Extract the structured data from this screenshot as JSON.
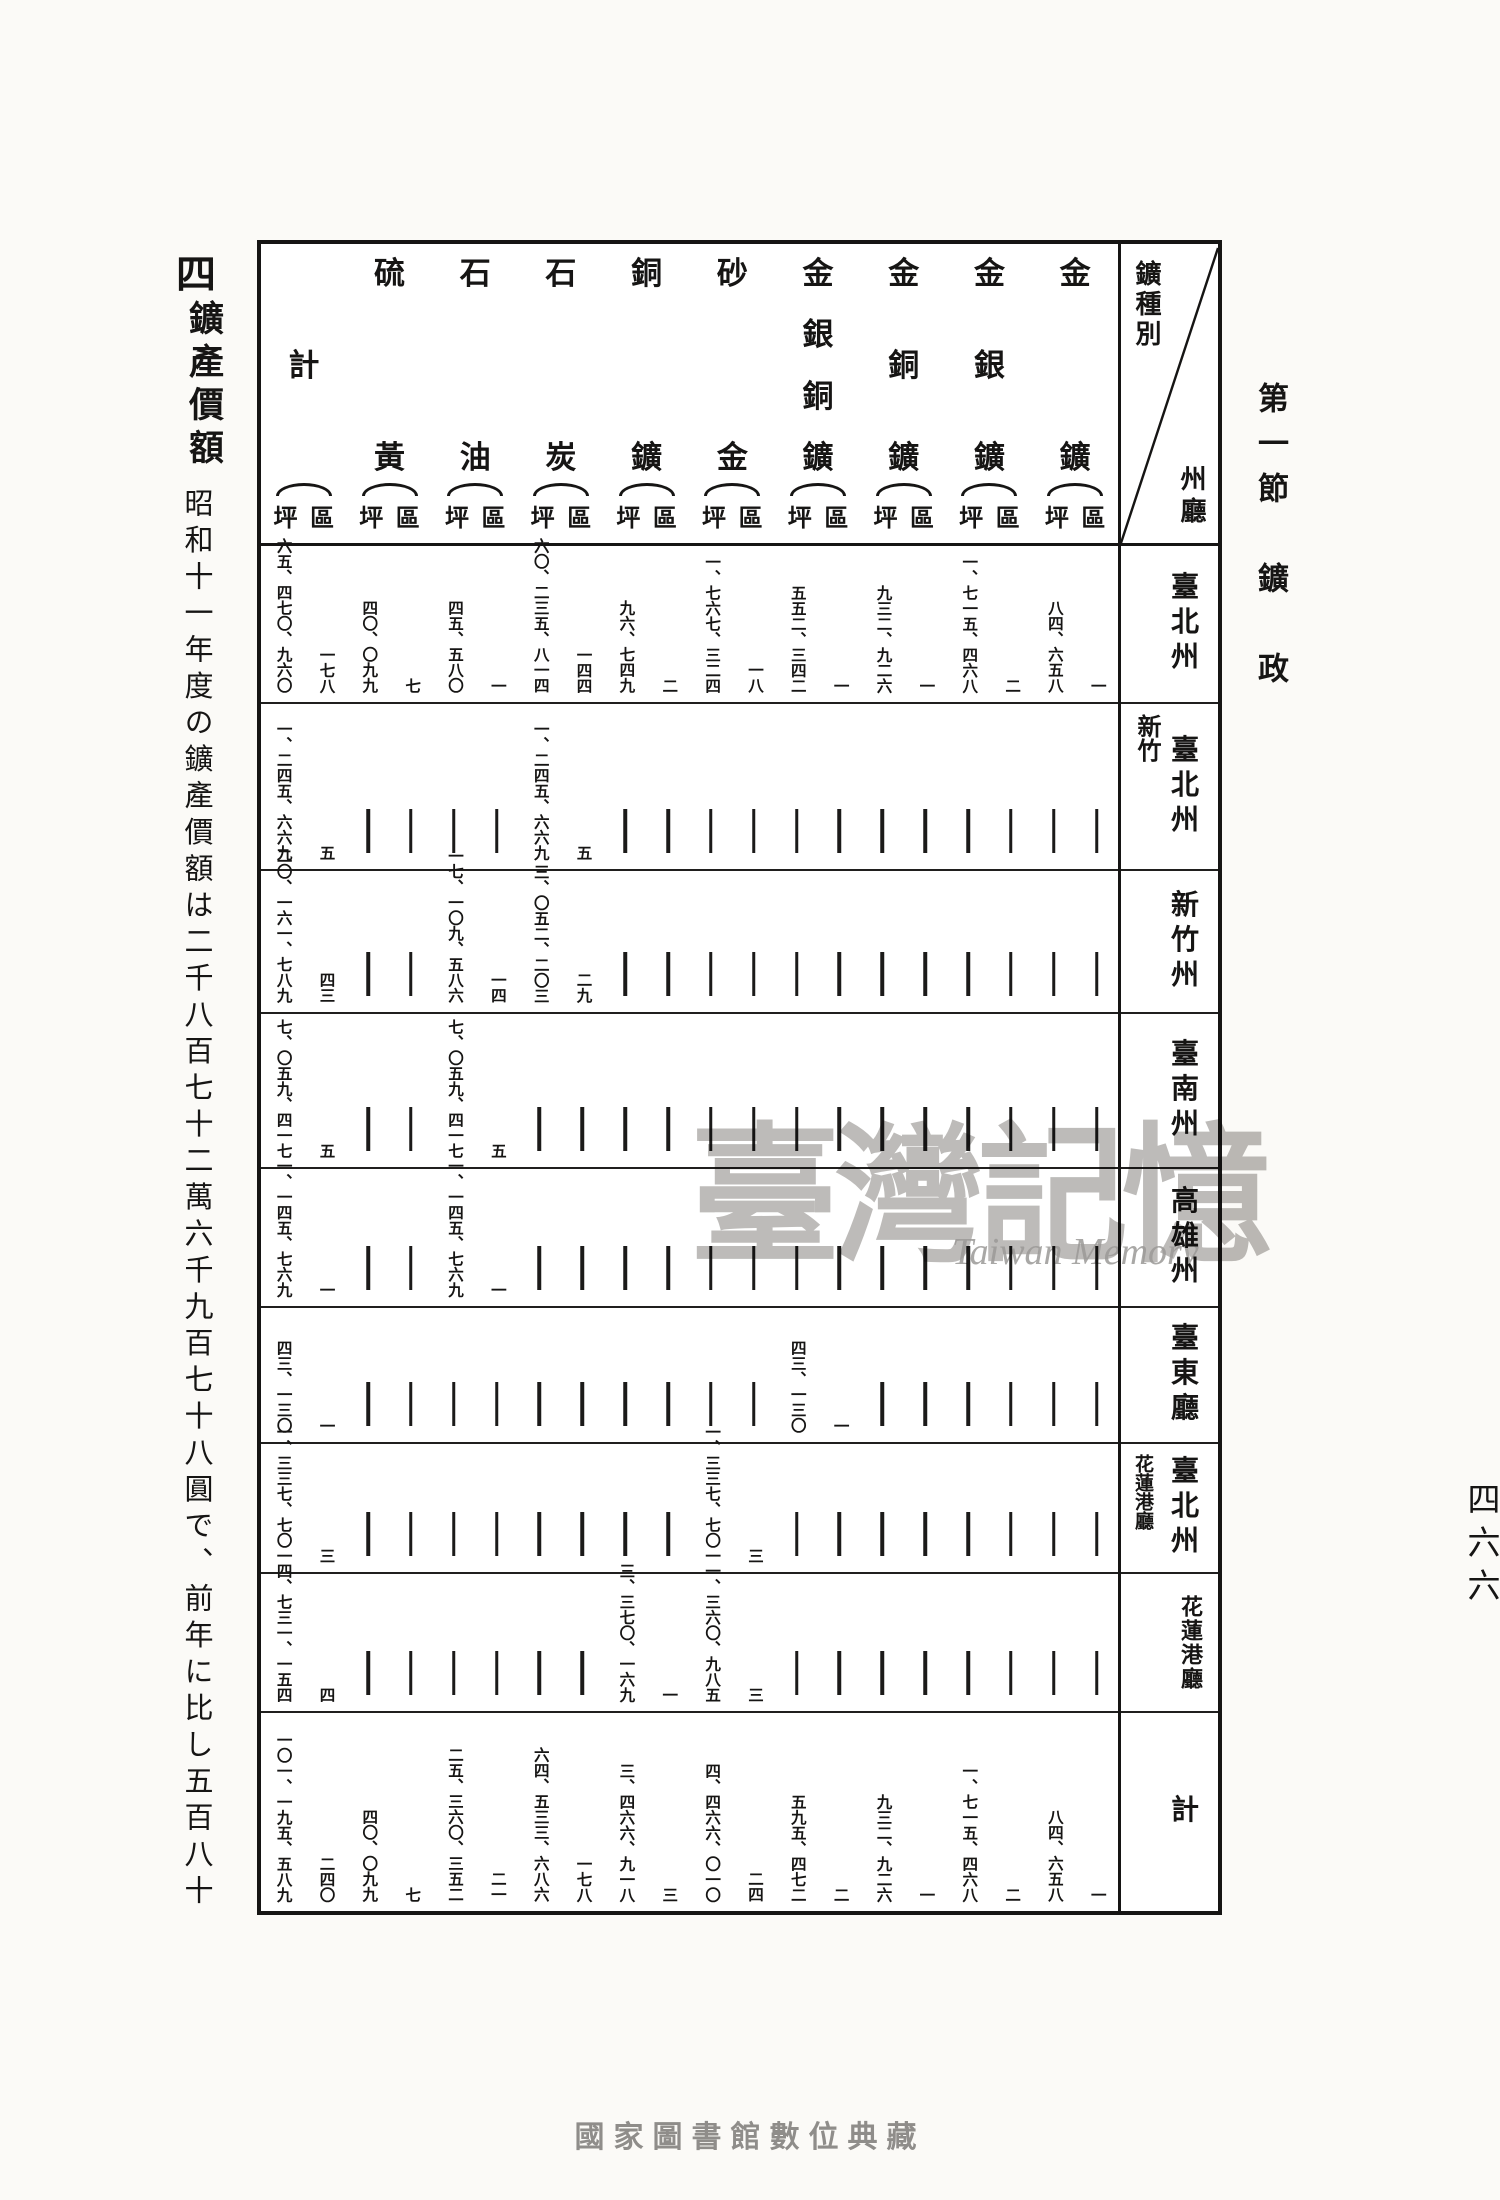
{
  "page": {
    "section_header": "第一節　鑛　政",
    "page_number": "四六六",
    "footer": "國家圖書館數位典藏"
  },
  "margin": {
    "index": "四",
    "heading": "鑛產價額",
    "body": "昭和十一年度の鑛產價額は二千八百七十二萬六千九百七十八圓で、前年に比し五百八十"
  },
  "watermark": {
    "cjk": "臺灣記憶",
    "latin": "Taiwan Memory"
  },
  "table": {
    "corner": {
      "top": "鑛種別",
      "bottom": "州廳"
    },
    "unit_right": "區",
    "unit_left": "坪",
    "columns": [
      {
        "key": "kin",
        "name": "金鑛",
        "chars": [
          "金",
          "鑛"
        ]
      },
      {
        "key": "kingin",
        "name": "金銀鑛",
        "chars": [
          "金",
          "銀",
          "鑛"
        ]
      },
      {
        "key": "kindo",
        "name": "金銅鑛",
        "chars": [
          "金",
          "銅",
          "鑛"
        ]
      },
      {
        "key": "kingindo",
        "name": "金銀銅鑛",
        "chars": [
          "金",
          "銀",
          "銅",
          "鑛"
        ]
      },
      {
        "key": "sakin",
        "name": "砂金",
        "chars": [
          "砂",
          "金"
        ]
      },
      {
        "key": "do",
        "name": "銅鑛",
        "chars": [
          "銅",
          "鑛"
        ]
      },
      {
        "key": "sekitan",
        "name": "石炭",
        "chars": [
          "石",
          "炭"
        ]
      },
      {
        "key": "sekiyu",
        "name": "石油",
        "chars": [
          "石",
          "油"
        ]
      },
      {
        "key": "io",
        "name": "硫黃",
        "chars": [
          "硫",
          "黃"
        ]
      },
      {
        "key": "kei",
        "name": "計",
        "chars": [
          "計"
        ]
      }
    ],
    "rows": [
      {
        "label": "臺北州",
        "stamp": "",
        "cells": {
          "kin": {
            "ku": "一",
            "tsubo": "八四、六五八"
          },
          "kingin": {
            "ku": "二",
            "tsubo": "一、七一五、四六八"
          },
          "kindo": {
            "ku": "一",
            "tsubo": "九三二、九二六"
          },
          "kingindo": {
            "ku": "一",
            "tsubo": "五五二、三四二"
          },
          "sakin": {
            "ku": "一八",
            "tsubo": "一、七六七、三二四"
          },
          "do": {
            "ku": "二",
            "tsubo": "九六、七四九"
          },
          "sekitan": {
            "ku": "一四四",
            "tsubo": "六〇、二三五、八一四"
          },
          "sekiyu": {
            "ku": "一",
            "tsubo": "四五、五八〇"
          },
          "io": {
            "ku": "七",
            "tsubo": "四〇、〇九九"
          },
          "kei": {
            "ku": "一七八",
            "tsubo": "六五、四七〇、九六〇"
          }
        }
      },
      {
        "label": "臺北州",
        "stamp": "新竹",
        "cells": {
          "sekitan": {
            "ku": "五",
            "tsubo": "一、二四五、六六九"
          },
          "kei": {
            "ku": "五",
            "tsubo": "一、二四五、六六九"
          }
        }
      },
      {
        "label": "新竹州",
        "stamp": "",
        "cells": {
          "sekiyu": {
            "ku": "一四",
            "tsubo": "一七、一〇九、五八六"
          },
          "sekitan": {
            "ku": "二九",
            "tsubo": "三、〇五二、二〇三"
          },
          "kei": {
            "ku": "四三",
            "tsubo": "二〇、一六一、七八九"
          }
        }
      },
      {
        "label": "臺南州",
        "stamp": "",
        "cells": {
          "sekiyu": {
            "ku": "五",
            "tsubo": "七、〇五九、四一七"
          },
          "kei": {
            "ku": "五",
            "tsubo": "七、〇五九、四一七"
          }
        }
      },
      {
        "label": "高雄州",
        "stamp": "",
        "cells": {
          "sekiyu": {
            "ku": "一",
            "tsubo": "一、一四五、七六九"
          },
          "kei": {
            "ku": "一",
            "tsubo": "一、一四五、七六九"
          }
        }
      },
      {
        "label": "臺東廳",
        "stamp": "",
        "cells": {
          "kingindo": {
            "ku": "一",
            "tsubo": "四三、一三〇"
          },
          "kei": {
            "ku": "一",
            "tsubo": "四三、一三〇"
          }
        }
      },
      {
        "label": "臺北州",
        "stamp": "花蓮港廳",
        "cells": {
          "sakin": {
            "ku": "三",
            "tsubo": "一、三三七、七〇一"
          },
          "kei": {
            "ku": "三",
            "tsubo": "一、三三七、七〇一"
          }
        }
      },
      {
        "label": "花蓮港廳",
        "stamp": "",
        "cells": {
          "do": {
            "ku": "一",
            "tsubo": "三、三七〇、一六九"
          },
          "sakin": {
            "ku": "三",
            "tsubo": "一、三六〇、九八五"
          },
          "kei": {
            "ku": "四",
            "tsubo": "四、七三一、一五四"
          }
        }
      },
      {
        "label": "計",
        "stamp": "",
        "cells": {
          "kin": {
            "ku": "一",
            "tsubo": "八四、六五八"
          },
          "kingin": {
            "ku": "二",
            "tsubo": "一、七一五、四六八"
          },
          "kindo": {
            "ku": "一",
            "tsubo": "九三二、九二六"
          },
          "kingindo": {
            "ku": "二",
            "tsubo": "五九五、四七二"
          },
          "sakin": {
            "ku": "二四",
            "tsubo": "四、四六六、〇一〇"
          },
          "do": {
            "ku": "三",
            "tsubo": "三、四六六、九一八"
          },
          "sekitan": {
            "ku": "一七八",
            "tsubo": "六四、五三三、六八六"
          },
          "sekiyu": {
            "ku": "二一",
            "tsubo": "二五、三六〇、三五二"
          },
          "io": {
            "ku": "七",
            "tsubo": "四〇、〇九九"
          },
          "kei": {
            "ku": "二四〇",
            "tsubo": "一〇一、一九五、五八九"
          }
        }
      }
    ]
  }
}
